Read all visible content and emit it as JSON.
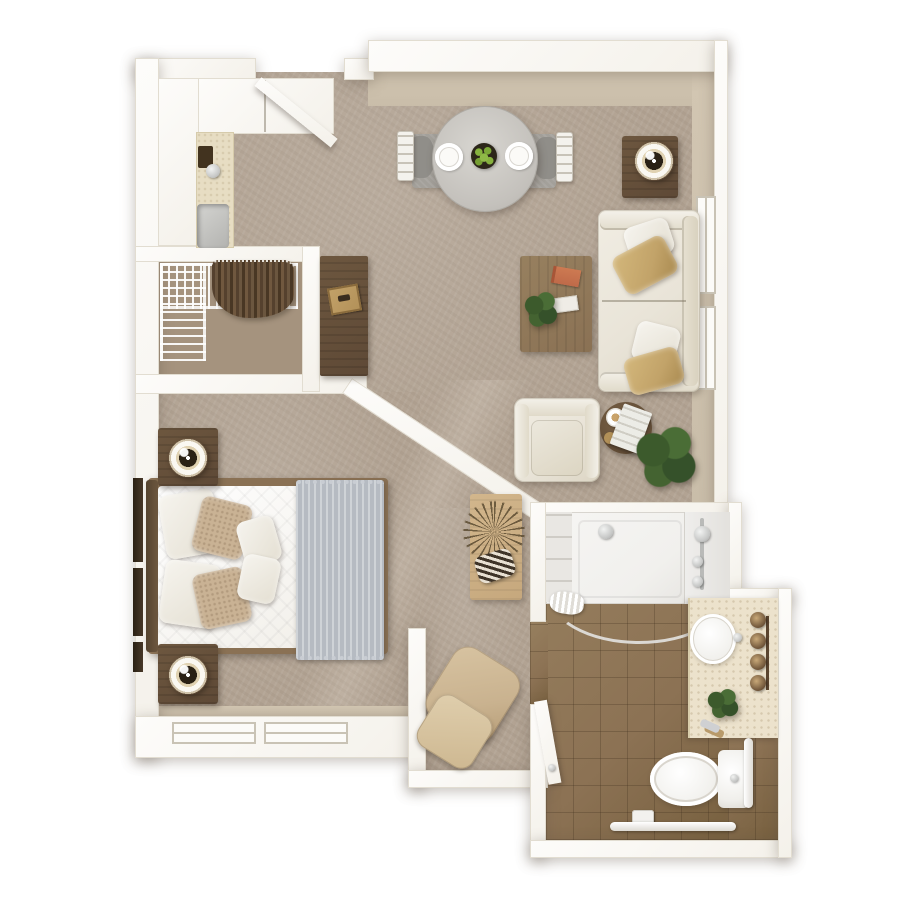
{
  "palette": {
    "background": "#ffffff",
    "wall": "#f4f1ea",
    "wall_edge": "#e2ddd1",
    "wall_face": "#c9bda9",
    "carpet": "#b2a393",
    "carpet_dark": "#a5937e",
    "tile": "#8c7254",
    "shower_white": "#f1f0ed",
    "wood_dark": "#5e4936",
    "wood_mid": "#8a7154",
    "wood_light": "#c6a87d",
    "counter_cream": "#e7ddc3",
    "vanity_cream": "#ece2cc",
    "cream": "#e9e4d8",
    "tan": "#c9b294",
    "gold": "#c2a369",
    "blanket_gray": "#b6bbc2",
    "rug_gray": "#a3a09a",
    "plant_green": "#45602f",
    "chrome": "#c6c7c6",
    "brass": "#b29058",
    "recliner_tan": "#c9b28f"
  },
  "rooms": [
    {
      "id": "kitchenette"
    },
    {
      "id": "closet"
    },
    {
      "id": "living-dining"
    },
    {
      "id": "bedroom"
    },
    {
      "id": "hallway"
    },
    {
      "id": "recliner-nook"
    },
    {
      "id": "bathroom"
    }
  ],
  "furniture": [
    {
      "id": "entry-door",
      "room": "kitchenette",
      "state": "open"
    },
    {
      "id": "upper-cabinets",
      "room": "kitchenette"
    },
    {
      "id": "counter-with-sink",
      "room": "kitchenette"
    },
    {
      "id": "dining-table-round",
      "room": "living-dining",
      "items": [
        "plate",
        "plate",
        "fruit-bowl-apples"
      ]
    },
    {
      "id": "dining-chair",
      "count": 2
    },
    {
      "id": "dining-rug"
    },
    {
      "id": "side-table-with-lamp",
      "room": "living-dining"
    },
    {
      "id": "sofa",
      "pillows": [
        "white",
        "gold",
        "white",
        "gold"
      ]
    },
    {
      "id": "coffee-table",
      "items": [
        "book-orange",
        "notepad",
        "plant-sprig"
      ]
    },
    {
      "id": "armchair"
    },
    {
      "id": "round-end-table",
      "items": [
        "coffee-cup",
        "magazine",
        "coaster"
      ]
    },
    {
      "id": "floor-plant"
    },
    {
      "id": "media-console",
      "items": [
        "brass-tray"
      ]
    },
    {
      "id": "wire-shelving-l-shape",
      "room": "closet"
    },
    {
      "id": "hanging-clothes",
      "room": "closet"
    },
    {
      "id": "bed-double",
      "room": "bedroom",
      "bedding": [
        "white-duvet",
        "gray-throw",
        "pillows"
      ]
    },
    {
      "id": "nightstand-with-lamp",
      "count": 2
    },
    {
      "id": "wall-art-frames",
      "count": 3
    },
    {
      "id": "console-table",
      "room": "hallway",
      "items": [
        "dried-palm",
        "striped-basket"
      ]
    },
    {
      "id": "recliner",
      "room": "recliner-nook"
    },
    {
      "id": "shower-with-curtain-rod",
      "room": "bathroom"
    },
    {
      "id": "shower-fixtures"
    },
    {
      "id": "vanity-with-round-sink",
      "items": [
        "sconce-lights-x4",
        "plant"
      ]
    },
    {
      "id": "toilet"
    },
    {
      "id": "grab-bar",
      "count": 2
    },
    {
      "id": "toilet-paper-holder"
    },
    {
      "id": "bathroom-door",
      "state": "open"
    },
    {
      "id": "window",
      "count": 4
    }
  ]
}
